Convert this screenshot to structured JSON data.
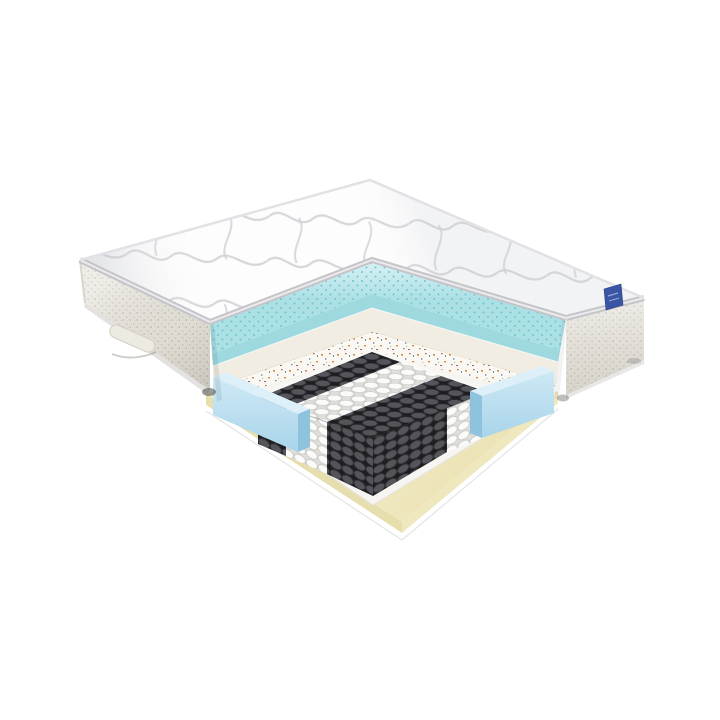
{
  "meta": {
    "type": "product-render",
    "description": "3D cutaway render of a hybrid pocket-spring mattress showing its internal layers",
    "background": "#ffffff"
  },
  "parts": {
    "cover": "quilted-top-cover",
    "side": "woven-side-border",
    "handle": "side-handle",
    "tag": "brand-tag",
    "gel": "cooling-gel-foam-layer",
    "foam": "soft-comfort-foam-layer",
    "coir": "coir-felt-pad-layer",
    "springs": "pocket-spring-unit",
    "springs_soft": "soft-zone-springs",
    "springs_firm": "firm-zone-springs",
    "edge": "edge-support-foam-rail",
    "base": "base-foam-layer",
    "bottom": "bottom-felt-pad"
  },
  "colors": {
    "quilt_white": "#fdfdfd",
    "quilt_stitch": "#d2d2d7",
    "piping": "#c4c4c9",
    "piping_highlight": "#ebebee",
    "back_edge": "#e2e2e6",
    "fabric_side": "#eae7e0",
    "fabric_speck": "#d6d1c3",
    "fabric_speck_dark": "#cbc5b5",
    "handle_fill": "#edeae1",
    "handle_edge": "#d2cec2",
    "tag_navy": "#3a55a4",
    "tag_stitch": "#93a7da",
    "gel_top_light": "#d8f1f3",
    "gel_top_deep": "#abe0e5",
    "gel_dot": "#6ec5cf",
    "gel_face": "#9fd9e0",
    "comfort_foam": "#f2ede2",
    "comfort_foam_edge": "#ddd5c2",
    "coir_bg": "#faf8f2",
    "coir_speck_orange": "#cf8a4e",
    "coir_speck_brown": "#ae603c",
    "coir_speck_blue": "#8fa9c6",
    "coir_speck_gray": "#8a8a8a",
    "spring_white": "#fbfbfa",
    "spring_white_line": "#c7c7c5",
    "spring_white_gap": "#dededb",
    "spring_dark": "#54555a",
    "spring_dark_line": "#333338",
    "spring_dark_gap": "#1e1e20",
    "floor_white": "#f8f8f5",
    "pad_white": "#f6f5f1",
    "pad_edge": "#e6e4de",
    "rail_top": "#ddeff8",
    "rail_face_light": "#cfe9f5",
    "rail_face_deep": "#a8d4ea",
    "rail_end": "#8fc2dd",
    "base_top_light": "#f4eeca",
    "base_top_deep": "#ece3b6",
    "base_face_left": "#e7deae",
    "base_face_right": "#efe7bd",
    "bottom_pad": "#ffffff",
    "bottom_edge": "#e4e4e2",
    "shadow_dark": "#3a3a38"
  }
}
